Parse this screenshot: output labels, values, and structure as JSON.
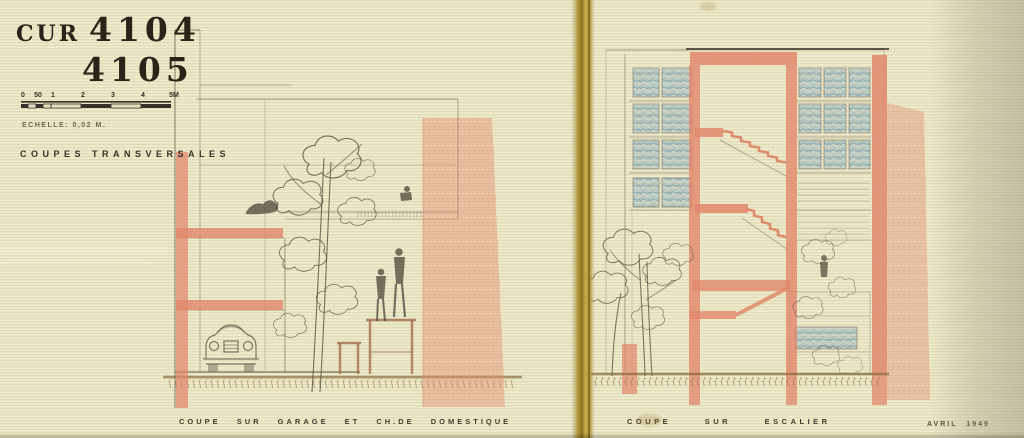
{
  "document": {
    "archive_prefix": "CUR",
    "drawing_number_1": "4104",
    "drawing_number_2": "4105",
    "scale_note": "ECHELLE: 0,02 M.",
    "series_title": "COUPES TRANSVERSALES",
    "date_note": "AVRIL 1949"
  },
  "scale_bar": {
    "unit_labels": [
      "0",
      "50",
      "1",
      "2",
      "3",
      "4",
      "5M"
    ]
  },
  "sections": [
    {
      "id": "coupe-garage",
      "caption": "COUPE SUR GARAGE ET CH.DE DOMESTIQUE"
    },
    {
      "id": "coupe-escalier",
      "caption": "COUPE SUR ESCALIER"
    }
  ],
  "palette": {
    "paper": "#ebe6c3",
    "binding_tape": "#b1922e",
    "red_pencil": "#e2876c",
    "blue_pencil": "#a9c0c2",
    "graphite": "#5f5849",
    "ground_umber": "#8a6b3c",
    "ink": "#2b2318"
  }
}
